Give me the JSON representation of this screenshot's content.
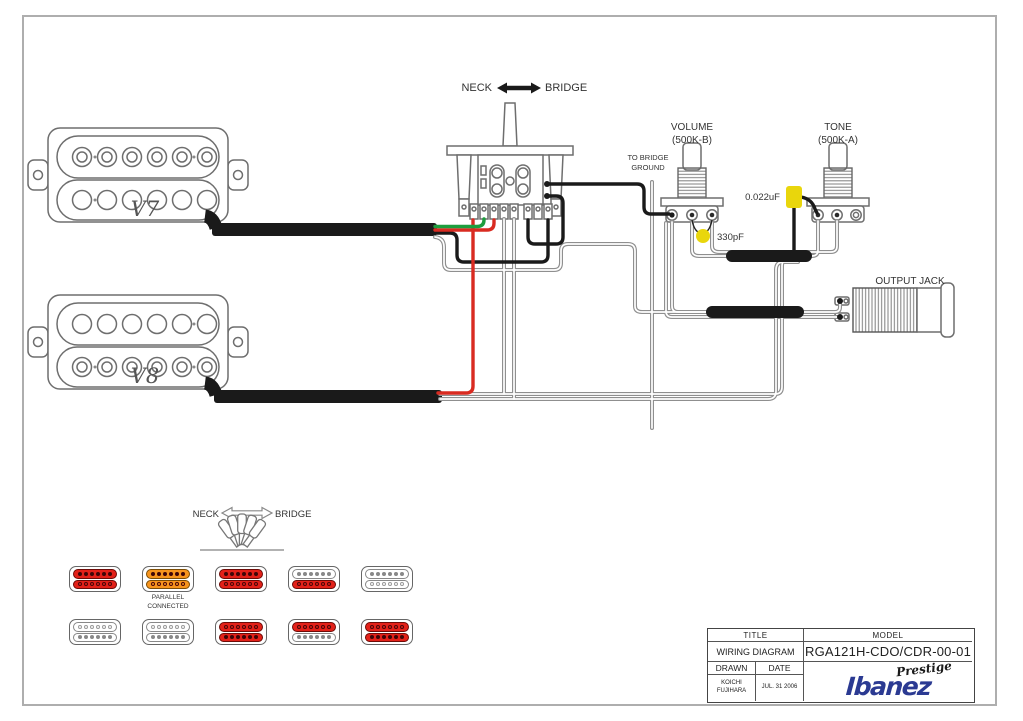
{
  "diagram": {
    "top_selector": {
      "neck": "NECK",
      "bridge": "BRIDGE"
    },
    "pickups": {
      "neck": "V7",
      "bridge": "V8"
    },
    "volume": {
      "name": "VOLUME",
      "spec": "(500K-B)"
    },
    "tone": {
      "name": "TONE",
      "spec": "(500K-A)"
    },
    "ground_label": {
      "line1": "TO BRIDGE",
      "line2": "GROUND"
    },
    "capacitors": {
      "tone_cap": "0.022uF",
      "treble_bleed": "330pF"
    },
    "output_jack": "OUTPUT JACK"
  },
  "selector_chart": {
    "neck": "NECK",
    "bridge": "BRIDGE",
    "positions": [
      {
        "neck": [
          "red",
          "red"
        ],
        "bridge": [
          "white",
          "white"
        ]
      },
      {
        "neck": [
          "orange",
          "orange"
        ],
        "bridge": [
          "white",
          "white"
        ],
        "note": "PARALLEL CONNECTED"
      },
      {
        "neck": [
          "red",
          "red"
        ],
        "bridge": [
          "red",
          "red"
        ]
      },
      {
        "neck": [
          "white",
          "red"
        ],
        "bridge": [
          "red",
          "white"
        ]
      },
      {
        "neck": [
          "white",
          "white"
        ],
        "bridge": [
          "red",
          "red"
        ]
      }
    ]
  },
  "title_block": {
    "title_header": "TITLE",
    "model_header": "MODEL",
    "title": "WIRING DIAGRAM",
    "model": "RGA121H-CDO/CDR-00-01",
    "drawn_header": "DRAWN",
    "date_header": "DATE",
    "drawn": "KOICHI FUJIHARA",
    "date": "JUL. 31 2006",
    "brand": "Ibanez",
    "brand_script": "Prestige"
  },
  "colors": {
    "coil_red": "#e32119",
    "coil_orange": "#f7941d",
    "cap_yellow": "#e9d60c",
    "brand_blue": "#2b3a92",
    "wire_red": "#d92b21",
    "wire_green": "#1d9e3e"
  }
}
